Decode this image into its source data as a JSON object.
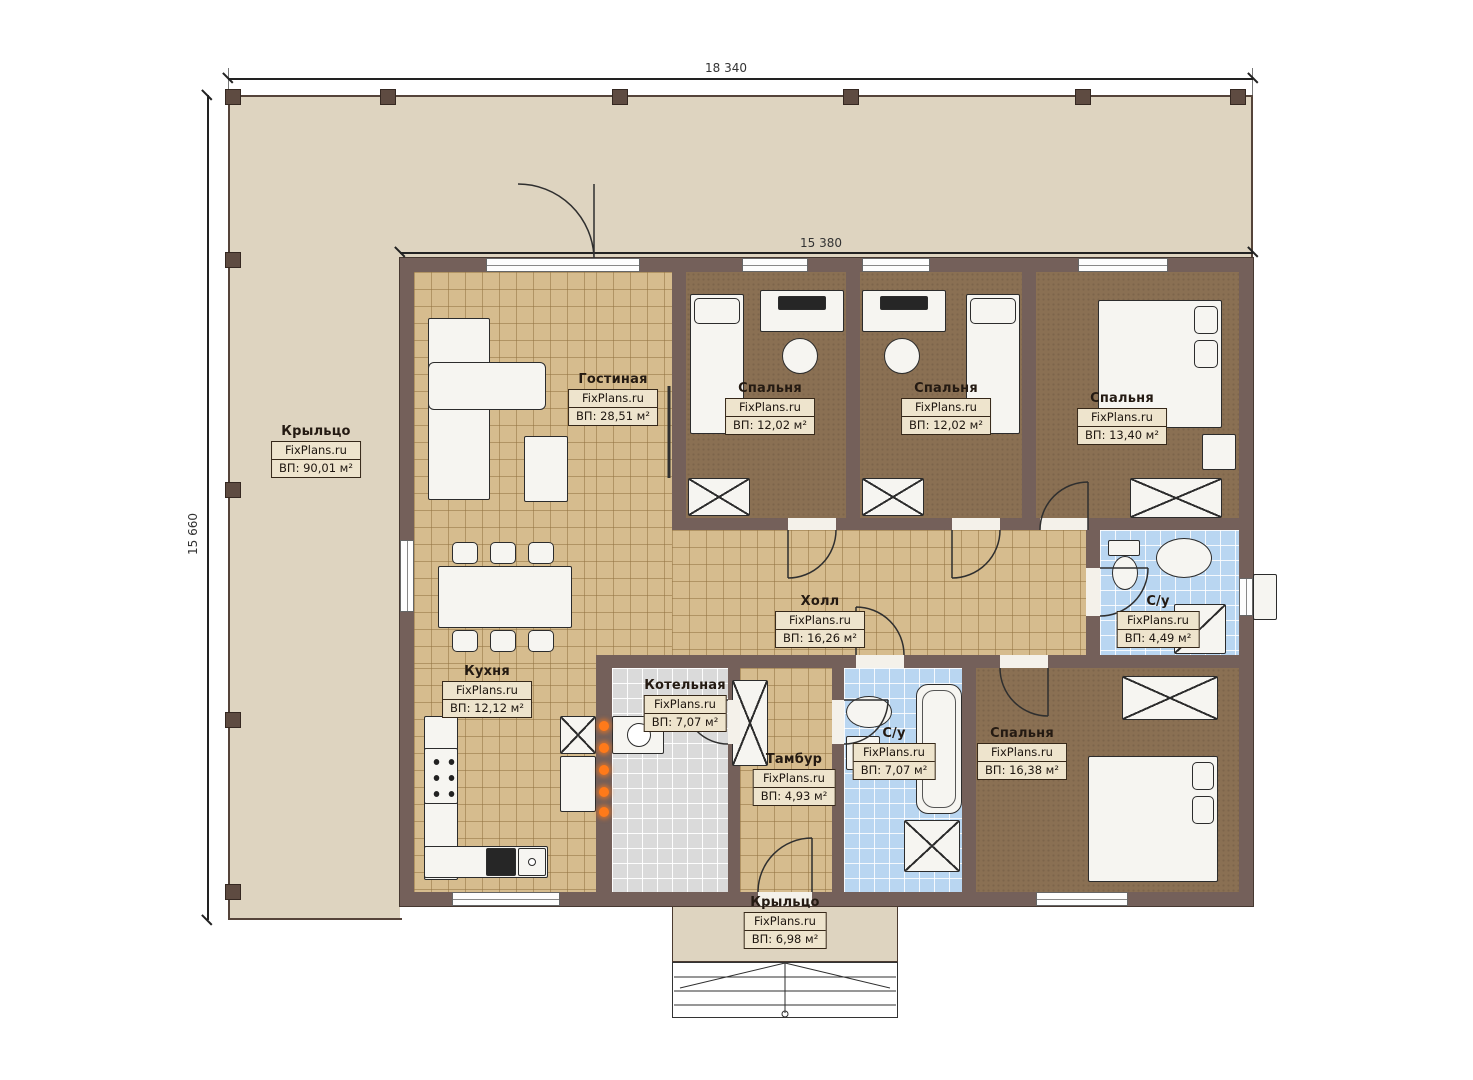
{
  "brand": "FixPlans.ru",
  "dims": {
    "width_total": "18 340",
    "width_house": "15 380",
    "height_total": "15 660"
  },
  "rooms": {
    "porch_left": {
      "name": "Крыльцо",
      "area": "ВП: 90,01 м²"
    },
    "living": {
      "name": "Гостиная",
      "area": "ВП: 28,51 м²"
    },
    "bedroom1": {
      "name": "Спальня",
      "area": "ВП: 12,02 м²"
    },
    "bedroom2": {
      "name": "Спальня",
      "area": "ВП: 12,02 м²"
    },
    "bedroom3": {
      "name": "Спальня",
      "area": "ВП: 13,40 м²"
    },
    "hall": {
      "name": "Холл",
      "area": "ВП: 16,26 м²"
    },
    "wc_top": {
      "name": "С/у",
      "area": "ВП: 4,49 м²"
    },
    "kitchen": {
      "name": "Кухня",
      "area": "ВП: 12,12 м²"
    },
    "boiler": {
      "name": "Котельная",
      "area": "ВП: 7,07 м²"
    },
    "tambour": {
      "name": "Тамбур",
      "area": "ВП: 4,93 м²"
    },
    "wc_bottom": {
      "name": "С/у",
      "area": "ВП: 7,07 м²"
    },
    "bedroom4": {
      "name": "Спальня",
      "area": "ВП: 16,38 м²"
    },
    "porch_bottom": {
      "name": "Крыльцо",
      "area": "ВП: 6,98 м²"
    }
  },
  "colors": {
    "wall": "#74605a",
    "porch": "#ded4c0",
    "floor_tile_tan": "#d6bc8e",
    "floor_carpet": "#8a7053",
    "floor_tile_blue": "#b9d6f1",
    "floor_tile_gray": "#dadada",
    "radiator": "#ff7a1a"
  }
}
